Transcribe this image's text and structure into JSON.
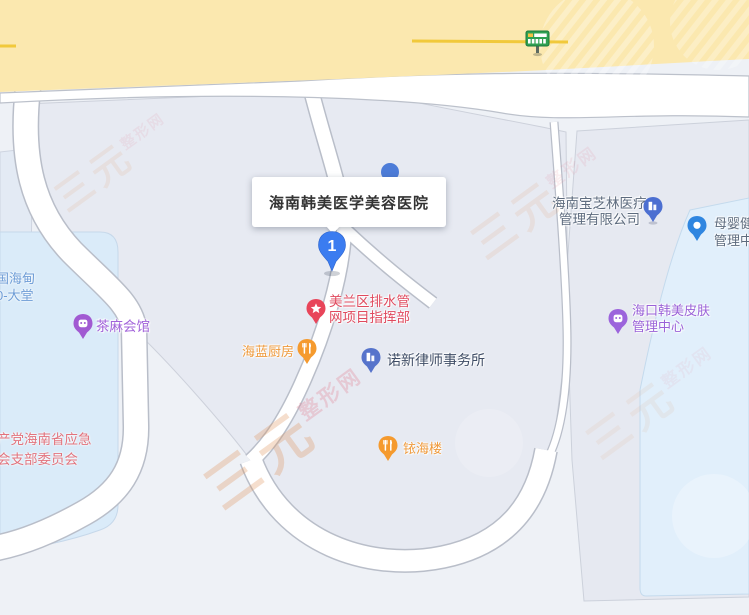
{
  "callout": {
    "title": "海南韩美医学美容医院",
    "marker_number": "1"
  },
  "pois": [
    {
      "line1": "海南宝芝林医疗",
      "line2": "管理有限公司",
      "icon": "company-building-pin",
      "pin_color": "#4c6fd1",
      "text_color": "#5d6b7e"
    },
    {
      "line1": "母婴健",
      "line2": "管理中",
      "icon": "dot-pin",
      "pin_color": "#2f86e0",
      "text_color": "#5d6b7e"
    },
    {
      "line1": "海口韩美皮肤",
      "line2": "管理中心",
      "icon": "beauty-pin",
      "pin_color": "#9c64dc",
      "text_color": "#9a62d8"
    },
    {
      "line1": "美兰区排水管",
      "line2": "网项目指挥部",
      "icon": "star-pin",
      "pin_color": "#e8455a",
      "text_color": "#e04a5e"
    },
    {
      "line1": "海蓝厨房",
      "line2": "",
      "icon": "restaurant-pin",
      "pin_color": "#f59a2e",
      "text_color": "#ef9a3c"
    },
    {
      "line1": "诺新律师事务所",
      "line2": "",
      "icon": "office-building-pin",
      "pin_color": "#5673cb",
      "text_color": "#3f4d66"
    },
    {
      "line1": "铱海楼",
      "line2": "",
      "icon": "restaurant-pin",
      "pin_color": "#f59a2e",
      "text_color": "#ef9a3c"
    },
    {
      "line1": "茶麻会馆",
      "line2": "",
      "icon": "teahouse-pin",
      "pin_color": "#a15ad2",
      "text_color": "#a263da"
    }
  ],
  "cut_labels": [
    {
      "line1": "国海甸",
      "line2": "0-大堂",
      "text_color": "#6d9cd6"
    },
    {
      "line1": "产党海南省应急",
      "line2": "会支部委员会",
      "text_color": "#e2737d"
    }
  ],
  "transit_stop": {
    "icon": "bus-stop-sign"
  },
  "watermark": {
    "brand_large": "三元",
    "brand_small": "整形网"
  },
  "colors": {
    "background": "#eef1f6",
    "block_fill": "#e7eaf2",
    "left_blue_block": "#daebf9",
    "right_blue_block": "#e1f0fc",
    "road_fill": "#ffffff",
    "road_casing": "#b9bec9",
    "highway_fill": "#fbe8af",
    "highway_centerline": "#f1c93b",
    "marker_blue": "#3b7cf0",
    "bus_stop_green": "#2fa052"
  }
}
